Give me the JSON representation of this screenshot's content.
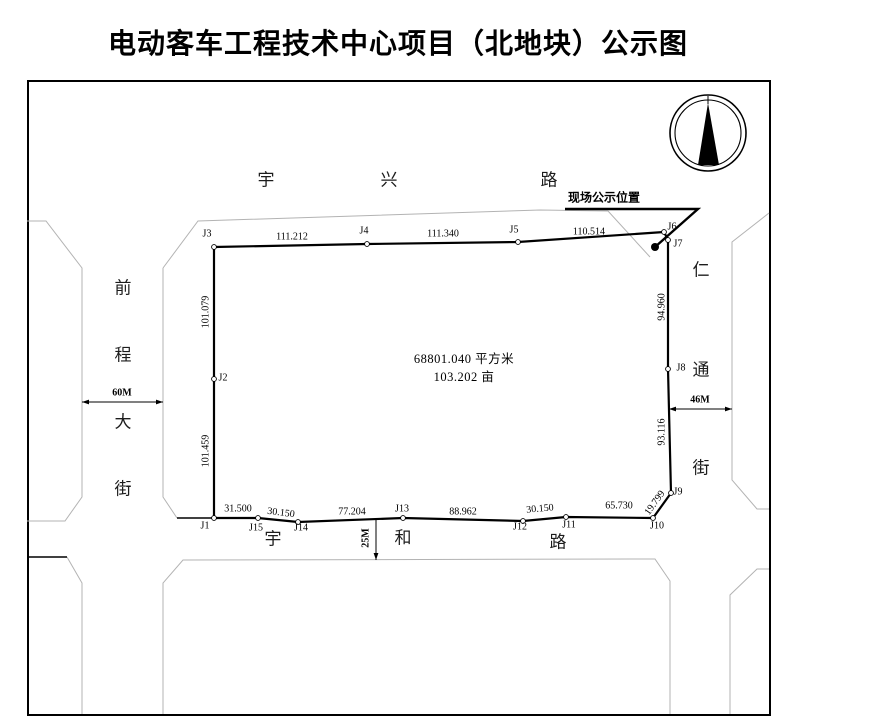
{
  "title": "电动客车工程技术中心项目（北地块）公示图",
  "notice": {
    "label": "现场公示位置"
  },
  "parcel": {
    "area_sqm": "68801.040 平方米",
    "area_mu": "103.202 亩"
  },
  "roads": [
    {
      "name": "宇兴路",
      "position": "top"
    },
    {
      "name": "前程大街",
      "position": "left",
      "width": "60M"
    },
    {
      "name": "仁通街",
      "position": "right",
      "width": "46M"
    },
    {
      "name": "宇和路",
      "position": "bottom",
      "width": "25M"
    }
  ],
  "boundary_points": [
    {
      "id": "J1",
      "x": 214,
      "y": 518
    },
    {
      "id": "J2",
      "x": 214,
      "y": 379
    },
    {
      "id": "J3",
      "x": 214,
      "y": 247
    },
    {
      "id": "J4",
      "x": 367,
      "y": 244
    },
    {
      "id": "J5",
      "x": 518,
      "y": 242
    },
    {
      "id": "J6",
      "x": 664,
      "y": 232
    },
    {
      "id": "J7",
      "x": 668,
      "y": 240
    },
    {
      "id": "J8",
      "x": 668,
      "y": 369
    },
    {
      "id": "J9",
      "x": 671,
      "y": 493
    },
    {
      "id": "J10",
      "x": 653,
      "y": 518
    },
    {
      "id": "J11",
      "x": 566,
      "y": 517
    },
    {
      "id": "J12",
      "x": 523,
      "y": 521
    },
    {
      "id": "J13",
      "x": 403,
      "y": 518
    },
    {
      "id": "J14",
      "x": 298,
      "y": 522
    },
    {
      "id": "J15",
      "x": 258,
      "y": 518
    }
  ],
  "boundary_order": [
    "J1",
    "J2",
    "J3",
    "J4",
    "J5",
    "J6",
    "J7",
    "J8",
    "J9",
    "J10",
    "J11",
    "J12",
    "J13",
    "J14",
    "J15",
    "J1"
  ],
  "segments": [
    {
      "from": "J3",
      "to": "J4",
      "length": "111.212"
    },
    {
      "from": "J4",
      "to": "J5",
      "length": "111.340"
    },
    {
      "from": "J5",
      "to": "J6",
      "length": "110.514"
    },
    {
      "from": "J2",
      "to": "J3",
      "length": "101.079"
    },
    {
      "from": "J1",
      "to": "J2",
      "length": "101.459"
    },
    {
      "from": "J7",
      "to": "J8",
      "length": "94.960"
    },
    {
      "from": "J8",
      "to": "J9",
      "length": "93.116"
    },
    {
      "from": "J9",
      "to": "J10",
      "length": "19.799"
    },
    {
      "from": "J10",
      "to": "J11",
      "length": "65.730"
    },
    {
      "from": "J11",
      "to": "J12",
      "length": "30.150"
    },
    {
      "from": "J12",
      "to": "J13",
      "length": "88.962"
    },
    {
      "from": "J13",
      "to": "J14",
      "length": "77.204"
    },
    {
      "from": "J14",
      "to": "J15",
      "length": "30.150"
    },
    {
      "from": "J15",
      "to": "J1",
      "length": "31.500"
    }
  ],
  "labels": [
    {
      "t": "宇",
      "x": 266,
      "y": 178,
      "cls": "street"
    },
    {
      "t": "兴",
      "x": 389,
      "y": 178,
      "cls": "street"
    },
    {
      "t": "路",
      "x": 549,
      "y": 178,
      "cls": "street"
    },
    {
      "t": "前",
      "x": 123,
      "y": 286,
      "cls": "street"
    },
    {
      "t": "程",
      "x": 123,
      "y": 353,
      "cls": "street"
    },
    {
      "t": "大",
      "x": 123,
      "y": 420,
      "cls": "street"
    },
    {
      "t": "街",
      "x": 123,
      "y": 487,
      "cls": "street"
    },
    {
      "t": "仁",
      "x": 701,
      "y": 268,
      "cls": "street"
    },
    {
      "t": "通",
      "x": 701,
      "y": 368,
      "cls": "street"
    },
    {
      "t": "街",
      "x": 701,
      "y": 466,
      "cls": "street"
    },
    {
      "t": "宇",
      "x": 273,
      "y": 537,
      "cls": "street"
    },
    {
      "t": "和",
      "x": 403,
      "y": 536,
      "cls": "street"
    },
    {
      "t": "路",
      "x": 558,
      "y": 540,
      "cls": "street"
    },
    {
      "t": "J1",
      "x": 205,
      "y": 526,
      "cls": "pt"
    },
    {
      "t": "J2",
      "x": 223,
      "y": 378,
      "cls": "pt"
    },
    {
      "t": "J3",
      "x": 207,
      "y": 234,
      "cls": "pt"
    },
    {
      "t": "J4",
      "x": 364,
      "y": 231,
      "cls": "pt"
    },
    {
      "t": "J5",
      "x": 514,
      "y": 230,
      "cls": "pt"
    },
    {
      "t": "J6",
      "x": 672,
      "y": 227,
      "cls": "pt"
    },
    {
      "t": "J7",
      "x": 678,
      "y": 244,
      "cls": "pt"
    },
    {
      "t": "J8",
      "x": 681,
      "y": 368,
      "cls": "pt"
    },
    {
      "t": "J9",
      "x": 678,
      "y": 492,
      "cls": "pt"
    },
    {
      "t": "J10",
      "x": 657,
      "y": 526,
      "cls": "pt"
    },
    {
      "t": "J11",
      "x": 569,
      "y": 525,
      "cls": "pt"
    },
    {
      "t": "J12",
      "x": 520,
      "y": 527,
      "cls": "pt"
    },
    {
      "t": "J13",
      "x": 402,
      "y": 509,
      "cls": "pt"
    },
    {
      "t": "J14",
      "x": 301,
      "y": 528,
      "cls": "pt"
    },
    {
      "t": "J15",
      "x": 256,
      "y": 528,
      "cls": "pt"
    },
    {
      "t": "111.212",
      "x": 292,
      "y": 237,
      "cls": "dist"
    },
    {
      "t": "111.340",
      "x": 443,
      "y": 234,
      "cls": "dist"
    },
    {
      "t": "110.514",
      "x": 589,
      "y": 232,
      "cls": "dist"
    },
    {
      "t": "101.079",
      "x": 206,
      "y": 312,
      "rot": -90,
      "cls": "dist"
    },
    {
      "t": "101.459",
      "x": 206,
      "y": 451,
      "rot": -90,
      "cls": "dist"
    },
    {
      "t": "94.960",
      "x": 662,
      "y": 307,
      "rot": -90,
      "cls": "dist"
    },
    {
      "t": "93.116",
      "x": 662,
      "y": 432,
      "rot": -90,
      "cls": "dist"
    },
    {
      "t": "19.799",
      "x": 655,
      "y": 503,
      "rot": -54,
      "cls": "dist"
    },
    {
      "t": "65.730",
      "x": 619,
      "y": 506,
      "cls": "dist"
    },
    {
      "t": "30.150",
      "x": 540,
      "y": 509,
      "rot": -5,
      "cls": "dist"
    },
    {
      "t": "88.962",
      "x": 463,
      "y": 512,
      "cls": "dist"
    },
    {
      "t": "77.204",
      "x": 352,
      "y": 512,
      "cls": "dist"
    },
    {
      "t": "30.150",
      "x": 281,
      "y": 513,
      "rot": 7,
      "cls": "dist"
    },
    {
      "t": "31.500",
      "x": 238,
      "y": 509,
      "cls": "dist"
    },
    {
      "t": "60M",
      "x": 122,
      "y": 393,
      "cls": "dim"
    },
    {
      "t": "46M",
      "x": 700,
      "y": 400,
      "cls": "dim"
    },
    {
      "t": "25M",
      "x": 366,
      "y": 538,
      "rot": -90,
      "cls": "dim"
    }
  ],
  "geometry": {
    "road_lines": [
      [
        [
          27,
          221
        ],
        [
          46,
          221
        ],
        [
          82,
          268
        ],
        [
          82,
          497
        ],
        [
          65,
          521
        ],
        [
          27,
          521
        ]
      ],
      [
        [
          163,
          268
        ],
        [
          198,
          221
        ],
        [
          540,
          210
        ],
        [
          608,
          211
        ],
        [
          650,
          257
        ]
      ],
      [
        [
          163,
          268
        ],
        [
          163,
          497
        ],
        [
          177,
          518
        ]
      ],
      [
        [
          67,
          557
        ],
        [
          82,
          583
        ],
        [
          82,
          714
        ]
      ],
      [
        [
          163,
          714
        ],
        [
          163,
          583
        ],
        [
          183,
          560
        ],
        [
          655,
          559
        ],
        [
          670,
          581
        ],
        [
          670,
          714
        ]
      ],
      [
        [
          769,
          213
        ],
        [
          732,
          242
        ],
        [
          732,
          480
        ],
        [
          757,
          509
        ],
        [
          769,
          509
        ]
      ],
      [
        [
          769,
          569
        ],
        [
          757,
          569
        ],
        [
          730,
          595
        ],
        [
          730,
          714
        ]
      ]
    ],
    "black_lines": [
      [
        [
          27,
          557
        ],
        [
          67,
          557
        ]
      ],
      [
        [
          177,
          518
        ],
        [
          214,
          518
        ]
      ]
    ],
    "leader": [
      [
        565,
        209
      ],
      [
        698,
        209
      ],
      [
        655,
        247
      ]
    ],
    "marker_dot": {
      "x": 655,
      "y": 247,
      "r": 4
    },
    "dims": [
      {
        "name": "dimension-60m",
        "pts": [
          [
            82,
            402
          ],
          [
            163,
            402
          ]
        ],
        "arrows": "both"
      },
      {
        "name": "dimension-46m",
        "pts": [
          [
            669,
            409
          ],
          [
            732,
            409
          ]
        ],
        "arrows": "both"
      },
      {
        "name": "dimension-25m",
        "pts": [
          [
            376,
            519
          ],
          [
            376,
            560
          ]
        ],
        "arrows": "end"
      }
    ],
    "compass": {
      "cx": 708,
      "cy": 133,
      "r_outer": 38,
      "r_inner": 33,
      "needle": [
        [
          708,
          103
        ],
        [
          698,
          165
        ],
        [
          719,
          165
        ]
      ],
      "tail": [
        [
          708,
          96
        ],
        [
          708,
          104
        ]
      ]
    }
  }
}
